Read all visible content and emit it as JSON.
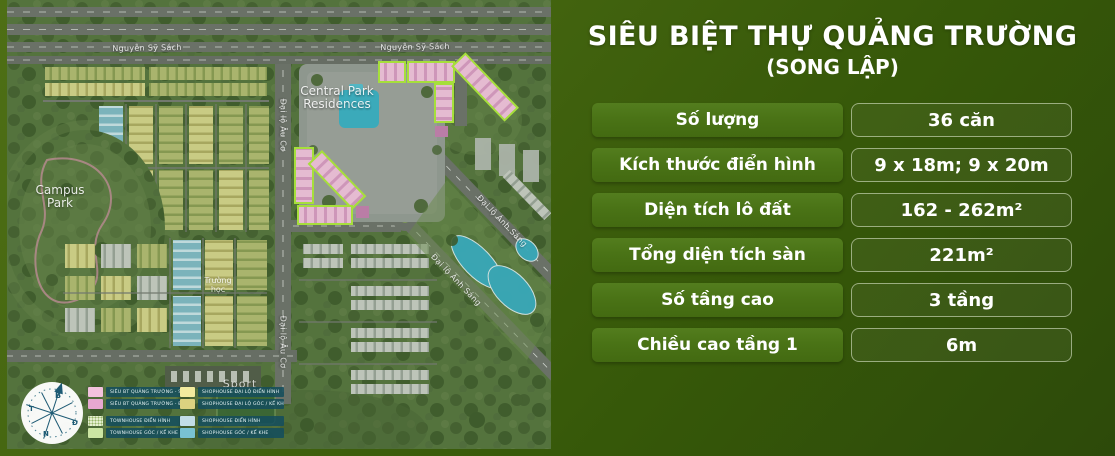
{
  "title": {
    "main": "SIÊU BIỆT THỰ QUẢNG TRƯỜNG",
    "sub": "(SONG LẬP)"
  },
  "specs": {
    "rows": [
      {
        "label": "Số lượng",
        "value": "36 căn"
      },
      {
        "label": "Kích thước điển hình",
        "value": "9 x 18m; 9 x 20m"
      },
      {
        "label": "Diện tích lô đất",
        "value": "162 - 262m²"
      },
      {
        "label": "Tổng diện tích sàn",
        "value": "221m²"
      },
      {
        "label": "Số tầng cao",
        "value": "3 tầng"
      },
      {
        "label": "Chiều cao tầng 1",
        "value": "6m"
      }
    ]
  },
  "map": {
    "labels": {
      "road_top_1": "Nguyễn Sỹ Sách",
      "road_top_2": "Nguyễn Sỹ Sách",
      "road_auco_1": "Đại lộ Âu Cơ",
      "road_auco_2": "Đại lộ Âu Cơ",
      "road_anhsang_1": "Đại lộ Ánh Sáng",
      "road_anhsang_2": "Đại lộ Ánh Sáng",
      "central_park_1": "Central Park",
      "central_park_2": "Residences",
      "campus_park_1": "Campus",
      "campus_park_2": "Park",
      "school_1": "Trường",
      "school_2": "học",
      "sport": "Sport"
    },
    "compass": {
      "north": "B",
      "south": "N",
      "east": "Đ",
      "west": "T"
    },
    "legend": {
      "left": [
        {
          "swatch_color": "#f2c2dd",
          "label": "SIÊU BT QUẢNG TRƯỜNG - SL"
        },
        {
          "swatch_color": "#e6a8d0",
          "label": "SIÊU BT QUẢNG TRƯỜNG - ĐL"
        },
        {
          "swatch_color": "#e4efcf",
          "label": "TOWNHOUSE ĐIỂN HÌNH"
        },
        {
          "swatch_color": "#cbe5a3",
          "label": "TOWNHOUSE GÓC / KẾ KHE"
        }
      ],
      "right": [
        {
          "swatch_color": "#f2eb9e",
          "label": "SHOPHOUSE ĐẠI LỘ ĐIỂN HÌNH"
        },
        {
          "swatch_color": "#dcd280",
          "label": "SHOPHOUSE ĐẠI LỘ GÓC / KẾ KHE"
        },
        {
          "swatch_color": "#c2dde7",
          "label": "SHOPHOUSE ĐIỂN HÌNH"
        },
        {
          "swatch_color": "#79c2d2",
          "label": "SHOPHOUSE GÓC / KẾ KHE"
        }
      ]
    }
  },
  "colors": {
    "background_top": "#4e6f15",
    "background_bottom": "#2d4a0a",
    "table_label_bg": "#4a7316",
    "table_value_border": "rgba(233,242,219,0.55)",
    "highlight_outline": "#b4ef3f",
    "highlight_fill": "#f8c8e2",
    "legend_pill_bg": "#15505f",
    "water": "#3cb3c8",
    "road": "#72786f"
  }
}
